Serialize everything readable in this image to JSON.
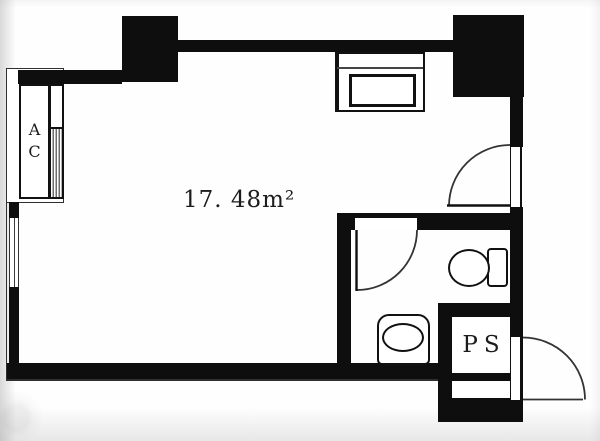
{
  "document": {
    "type": "architectural floor plan",
    "unit_shape": "studio apartment"
  },
  "labels": {
    "area": "17. 48m²",
    "air_conditioner": "AC",
    "pipe_shaft": "PS"
  },
  "colors": {
    "ink": "#0e0e0e",
    "paper": "#ffffff",
    "louver_gray": "#6d6d6d"
  },
  "features": {
    "rooms": [
      "main-room",
      "bathroom",
      "pipe-shaft-box"
    ],
    "doors": [
      "entry-door",
      "room-door",
      "bathroom-door"
    ],
    "windows": [
      "left-wall-window"
    ],
    "fixtures": [
      "air-conditioner-closet",
      "kitchen-counter-with-sink",
      "toilet",
      "wash-basin"
    ],
    "columns": [
      "top-left-column",
      "top-right-column"
    ]
  }
}
